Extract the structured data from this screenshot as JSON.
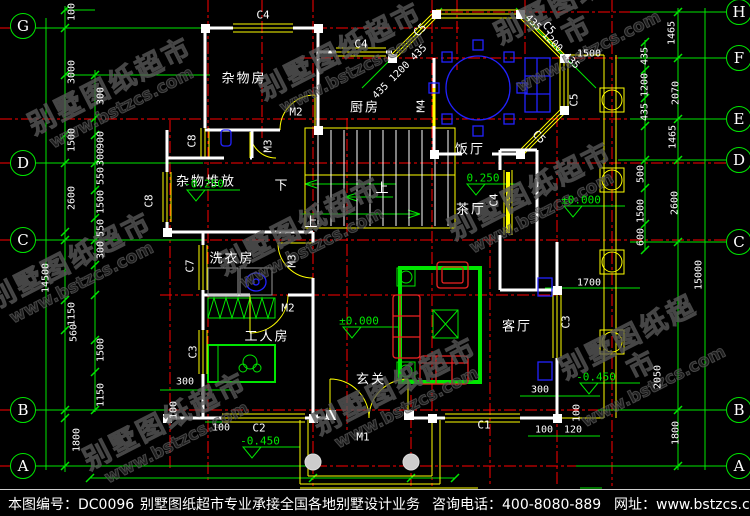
{
  "watermark": {
    "line1": "别墅图纸超市",
    "line2": "www.bstzcs.com"
  },
  "footer": {
    "sheet_no": "本图编号：DC0096",
    "slogan": "别墅图纸超市专业承接全国各地别墅设计业务",
    "phone": "咨询电话：400-8080-889",
    "website": "网址：www.bstzcs.com"
  },
  "axis_bubbles": {
    "left": [
      "G",
      "D",
      "C",
      "B",
      "A"
    ],
    "right": [
      "H",
      "F",
      "E",
      "D",
      "C",
      "B",
      "A"
    ]
  },
  "rooms": [
    "杂物房",
    "厨房",
    "饭厅",
    "杂物堆放",
    "洗衣房",
    "工人房",
    "茶厅",
    "玄关",
    "客厅"
  ],
  "levels": [
    "-0.250",
    "0.250",
    "±0.000",
    "±0.000",
    "-0.450",
    "-0.450"
  ],
  "stair_marks": [
    "下",
    "上",
    "上"
  ],
  "openings": [
    "C4",
    "C4",
    "C4",
    "C5",
    "C5",
    "C5",
    "C5",
    "C8",
    "C8",
    "C7",
    "C3",
    "C3",
    "C2",
    "C1",
    "M1",
    "M2",
    "M2",
    "M3",
    "M3",
    "M4"
  ],
  "dims": [
    "100",
    "3000",
    "300",
    "1500",
    "900",
    "300",
    "550",
    "2600",
    "1500",
    "550",
    "300",
    "14500",
    "1150",
    "560",
    "1500",
    "1150",
    "1800",
    "300",
    "100",
    "100",
    "300",
    "100",
    "100",
    "120",
    "1700",
    "1465",
    "435",
    "1200",
    "435",
    "2070",
    "1465",
    "500",
    "2600",
    "1500",
    "600",
    "2050",
    "1800",
    "15000",
    "435 1200 435",
    "435 1200 435",
    "1500"
  ],
  "colors": {
    "background": "#000000",
    "dimension_green": "#00e600",
    "axis_red": "#ff0000",
    "wall_white": "#ffffff",
    "window_door_yellow": "#ffff00",
    "furniture_blue": "#2222ff",
    "furniture_red": "#ee2222",
    "watermark_gray": "#585858"
  }
}
